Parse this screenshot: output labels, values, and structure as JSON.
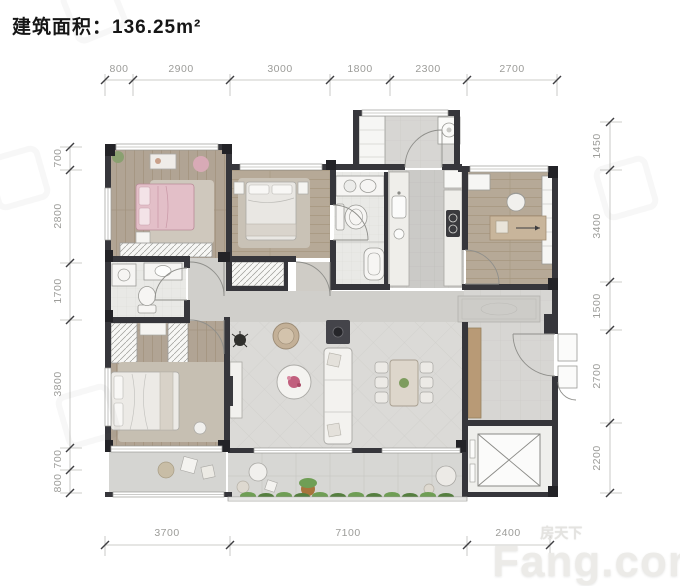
{
  "title": {
    "text": "建筑面积：136.25m²"
  },
  "dimensions": {
    "top": [
      "800",
      "2900",
      "3000",
      "1800",
      "2300",
      "2700"
    ],
    "left": [
      "700",
      "2800",
      "1700",
      "3800",
      "700",
      "800"
    ],
    "right": [
      "1450",
      "3400",
      "1500",
      "2700",
      "2200"
    ],
    "bottom": [
      "3700",
      "7100",
      "2400"
    ]
  },
  "watermark": {
    "brand_cn": "房天下",
    "brand_en": "Fang.com"
  },
  "colors": {
    "wall": "#36363b",
    "wood_floor": "#b3a795",
    "tile_floor": "#dadad6",
    "accent_pink": "#c15f7d",
    "plant_green": "#6f9e55",
    "dim_text": "#9b9b9b",
    "title_text": "#161616"
  }
}
